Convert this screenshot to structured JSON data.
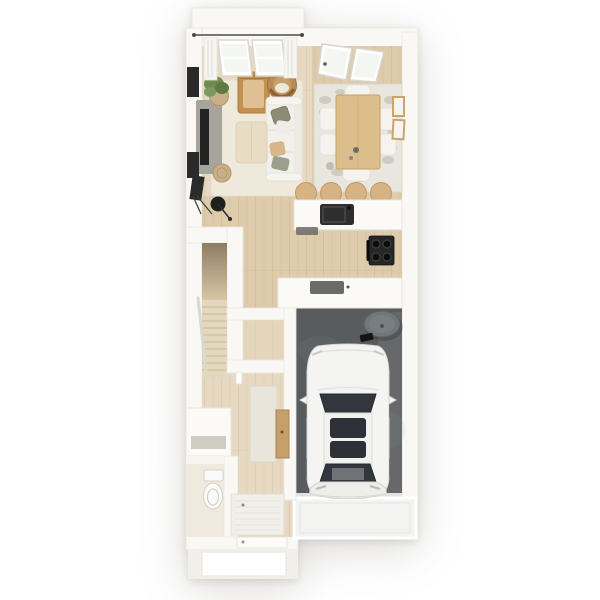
{
  "scene": {
    "type": "3d-floor-plan-render",
    "description": "Top-down 3D render of a narrow townhouse floor: open living and dining room with sofa and table at top, kitchen with island and range in the middle, staircase, entry hall with WC and storage, and a single-car garage with a white car parked on a dark concrete slab."
  },
  "colors": {
    "background": "#ffffff",
    "wall": "#f9f8f4",
    "wall_edge": "#e6e3db",
    "floor_wood_light": "#e7d9c1",
    "floor_wood": "#ddcbab",
    "rug_living": "#efe9db",
    "rug_dining": "#e9e6e0",
    "rug_pattern": "#b7b0a6",
    "runner_rug": "#eae5da",
    "door_mat": "#f1efe9",
    "garage_floor": "#595c5e",
    "apron": "#f3f4f2",
    "porch": "#f1efe9",
    "car_body": "#f4f4f2",
    "car_glass": "#33373d",
    "tv_console": "#a6a49b",
    "tv": "#232323",
    "sofa": "#f2f0eb",
    "pillow_olive": "#8a8d74",
    "pillow_peach": "#d9b68a",
    "pillow_sage": "#9aa08c",
    "ottoman": "#e8ddc4",
    "wood_chair": "#c2914f",
    "rattan": "#b98b55",
    "rattan_dark": "#8a5f35",
    "plant": "#6f8b52",
    "basket": "#c9b089",
    "dining_table": "#dcbd8c",
    "chair_white": "#f4f3ef",
    "stool": "#d6b384",
    "counter": "#fbfaf7",
    "sink": "#2e2e2e",
    "appliance_dark": "#6b6b67",
    "range": "#262626",
    "stair_tread": "#e3d7bd",
    "cylinder": "#70767a",
    "frame_black": "#2a2a2a",
    "frame_wood": "#caa46c",
    "toilet": "#fafaf8",
    "lamp_black": "#1f1f1f",
    "glass": "#f4f6f3",
    "curtain": "#f6f5f1",
    "rod": "#4a4a48",
    "wc_floor": "#efeadd",
    "hall_console": "#c6a06a"
  },
  "objects": {
    "living_room": [
      "area-rug",
      "sofa",
      "throw-pillows",
      "ottoman",
      "wood-armchair",
      "rattan-chair",
      "tv-console",
      "tv",
      "wall-art",
      "plant-basket",
      "floor-lamp",
      "jute-pouf",
      "curtains",
      "window"
    ],
    "dining_area": [
      "dining-table",
      "dining-chairs",
      "patterned-rug",
      "wall-frames",
      "glazed-balcony-door"
    ],
    "kitchen": [
      "island-counter",
      "sink",
      "faucet",
      "bar-stools",
      "range-cooker",
      "peninsula-counter",
      "cooktop"
    ],
    "circulation": [
      "staircase",
      "handrail",
      "stair-void",
      "closet",
      "hallway",
      "runner-rug",
      "console-table",
      "entry-mat",
      "front-door",
      "porch"
    ],
    "wc_storage": [
      "bench-cabinet",
      "open-shelf",
      "toilet"
    ],
    "garage": [
      "white-car",
      "water-heater",
      "garage-slab",
      "driveway-apron"
    ]
  }
}
